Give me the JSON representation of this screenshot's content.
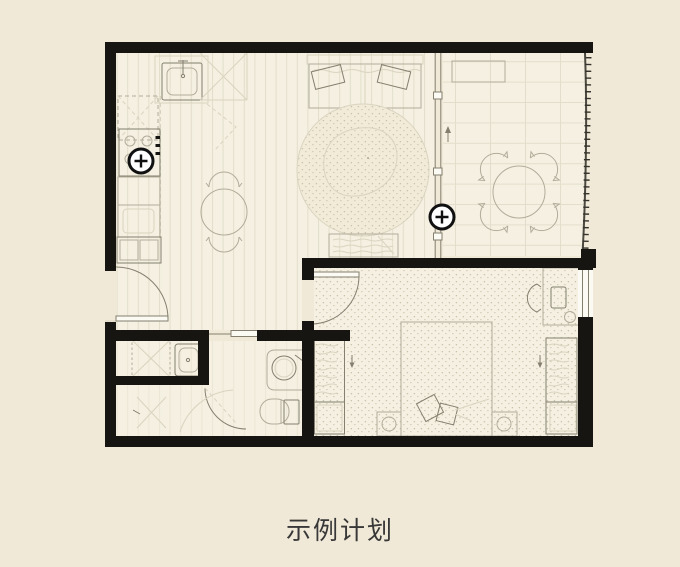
{
  "caption": {
    "text": "示例计划"
  },
  "colors": {
    "background": "#f1e9d7",
    "floor": "#f5f0e1",
    "wall": "#161512",
    "line": "#b1ac9a",
    "line_dark": "#847f6f",
    "carpet_dot": "#c9c3ad",
    "marker": "#111111",
    "caption_text": "#383838"
  },
  "markers": [
    {
      "name": "plus-marker-kitchen",
      "icon": "plus-circle",
      "symbol": "+",
      "x": 141,
      "y": 161
    },
    {
      "name": "plus-marker-partition",
      "icon": "plus-circle",
      "symbol": "+",
      "x": 442,
      "y": 217
    }
  ]
}
